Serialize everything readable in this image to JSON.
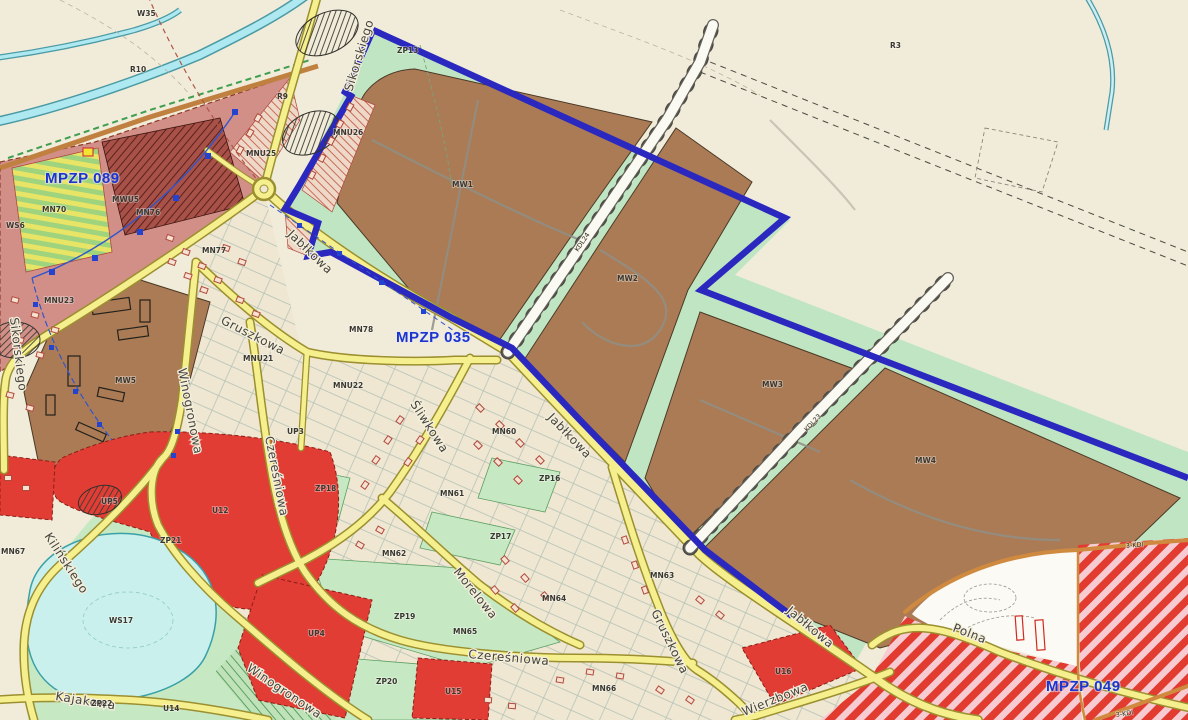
{
  "map": {
    "plan_labels": [
      {
        "text": "MPZP 089"
      },
      {
        "text": "MPZP 035"
      },
      {
        "text": "MPZP 049"
      }
    ],
    "streets": [
      {
        "name": "Sikorskiego"
      },
      {
        "name": "Sikorskiego"
      },
      {
        "name": "Jabłkowa"
      },
      {
        "name": "Jabłkowa"
      },
      {
        "name": "Jabłkowa"
      },
      {
        "name": "Gruszkowa"
      },
      {
        "name": "Gruszkowa"
      },
      {
        "name": "Śliwkowa"
      },
      {
        "name": "Czereśniowa"
      },
      {
        "name": "Czereśniowa"
      },
      {
        "name": "Morelowa"
      },
      {
        "name": "Winogronowa"
      },
      {
        "name": "Winogronowa"
      },
      {
        "name": "Kilińskiego"
      },
      {
        "name": "Kajakowa"
      },
      {
        "name": "Wierzbowa"
      },
      {
        "name": "Polna"
      }
    ],
    "road_codes": [
      {
        "code": "KDL24"
      },
      {
        "code": "KDL23"
      },
      {
        "code": "3-KDl"
      },
      {
        "code": "3-KDl"
      }
    ],
    "zones": [
      {
        "code": "W35"
      },
      {
        "code": "R10"
      },
      {
        "code": "R9"
      },
      {
        "code": "R3"
      },
      {
        "code": "ZP13"
      },
      {
        "code": "MNU25"
      },
      {
        "code": "MNU26"
      },
      {
        "code": "MWU5"
      },
      {
        "code": "MN70"
      },
      {
        "code": "MN76"
      },
      {
        "code": "MN77"
      },
      {
        "code": "MNU23"
      },
      {
        "code": "WS6"
      },
      {
        "code": "MW1"
      },
      {
        "code": "MW2"
      },
      {
        "code": "MW3"
      },
      {
        "code": "MW4"
      },
      {
        "code": "MW5"
      },
      {
        "code": "MNU21"
      },
      {
        "code": "MNU22"
      },
      {
        "code": "MN78"
      },
      {
        "code": "MN60"
      },
      {
        "code": "MN61"
      },
      {
        "code": "MN62"
      },
      {
        "code": "MN63"
      },
      {
        "code": "MN64"
      },
      {
        "code": "MN65"
      },
      {
        "code": "MN66"
      },
      {
        "code": "MN67"
      },
      {
        "code": "ZP16"
      },
      {
        "code": "ZP17"
      },
      {
        "code": "ZP18"
      },
      {
        "code": "ZP19"
      },
      {
        "code": "ZP20"
      },
      {
        "code": "ZP21"
      },
      {
        "code": "ZP22"
      },
      {
        "code": "UP3"
      },
      {
        "code": "UP4"
      },
      {
        "code": "UP5"
      },
      {
        "code": "U12"
      },
      {
        "code": "U14"
      },
      {
        "code": "U15"
      },
      {
        "code": "U16"
      },
      {
        "code": "WS17"
      }
    ],
    "colors": {
      "plan_boundary_blue": "#2a28bf",
      "plan_label_blue": "#1c35cf",
      "mw_brown": "#ab7b55",
      "green_zone": "#bfe5c2",
      "red_service": "#e23d35",
      "pink_mpzp089": "#d28f88",
      "hatch_red_stripe": "#e23b30",
      "road_yellow": "#f6ef8e",
      "water_cyan": "#aee8f0",
      "lake_cyan": "#c9f0ec",
      "farmland_beige": "#f1ecd9"
    }
  }
}
